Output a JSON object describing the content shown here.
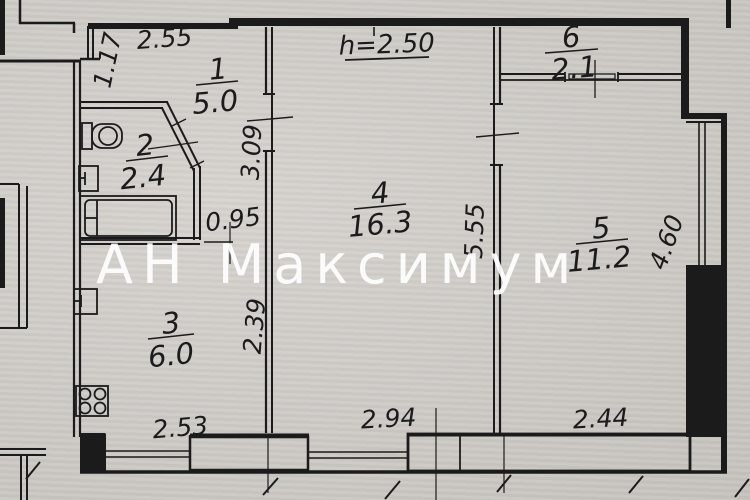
{
  "plan": {
    "watermark": "АН Максимум",
    "ceiling_height_label": "h=2.50",
    "rooms": [
      {
        "number": "1",
        "area": "5.0"
      },
      {
        "number": "2",
        "area": "2.4"
      },
      {
        "number": "3",
        "area": "6.0"
      },
      {
        "number": "4",
        "area": "16.3"
      },
      {
        "number": "5",
        "area": "11.2"
      },
      {
        "number": "6",
        "area": "2.1"
      }
    ],
    "dimensions": {
      "top_hall_width": "2.55",
      "entry_wall": "1.17",
      "hall_length": "3.09",
      "bath_corridor_width": "0.95",
      "living_room_length": "5.55",
      "right_room_length": "4.60",
      "kitchen_length": "2.39",
      "kitchen_width": "2.53",
      "living_room_width": "2.94",
      "right_room_width": "2.44"
    },
    "colors": {
      "paper": "#d2cfca",
      "ink": "#1b1b1b",
      "watermark": "#ffffff"
    }
  }
}
